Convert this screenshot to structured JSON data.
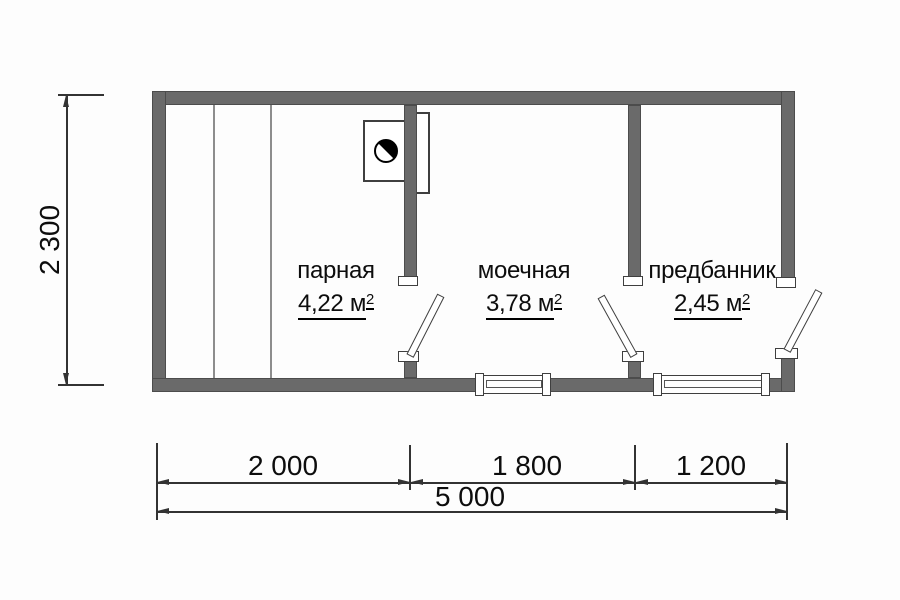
{
  "rooms": [
    {
      "name": "парная",
      "area_value": "4,22 м",
      "area_sup": "2"
    },
    {
      "name": "моечная",
      "area_value": "3,78 м",
      "area_sup": "2"
    },
    {
      "name": "предбанник",
      "area_value": "2,45 м",
      "area_sup": "2"
    }
  ],
  "dimensions": {
    "height_mm": "2 300",
    "width_segments_mm": [
      "2 000",
      "1 800",
      "1 200"
    ],
    "total_width_mm": "5 000"
  },
  "icons": {
    "stove": "stove-icon",
    "doors": [
      "door-leaf-icon",
      "door-leaf-icon",
      "door-leaf-icon"
    ],
    "windows": [
      "window-icon",
      "window-icon"
    ]
  },
  "colors": {
    "wall": "#6a6a6a",
    "line": "#333333",
    "text": "#111111",
    "background": "#fdfdfd"
  }
}
